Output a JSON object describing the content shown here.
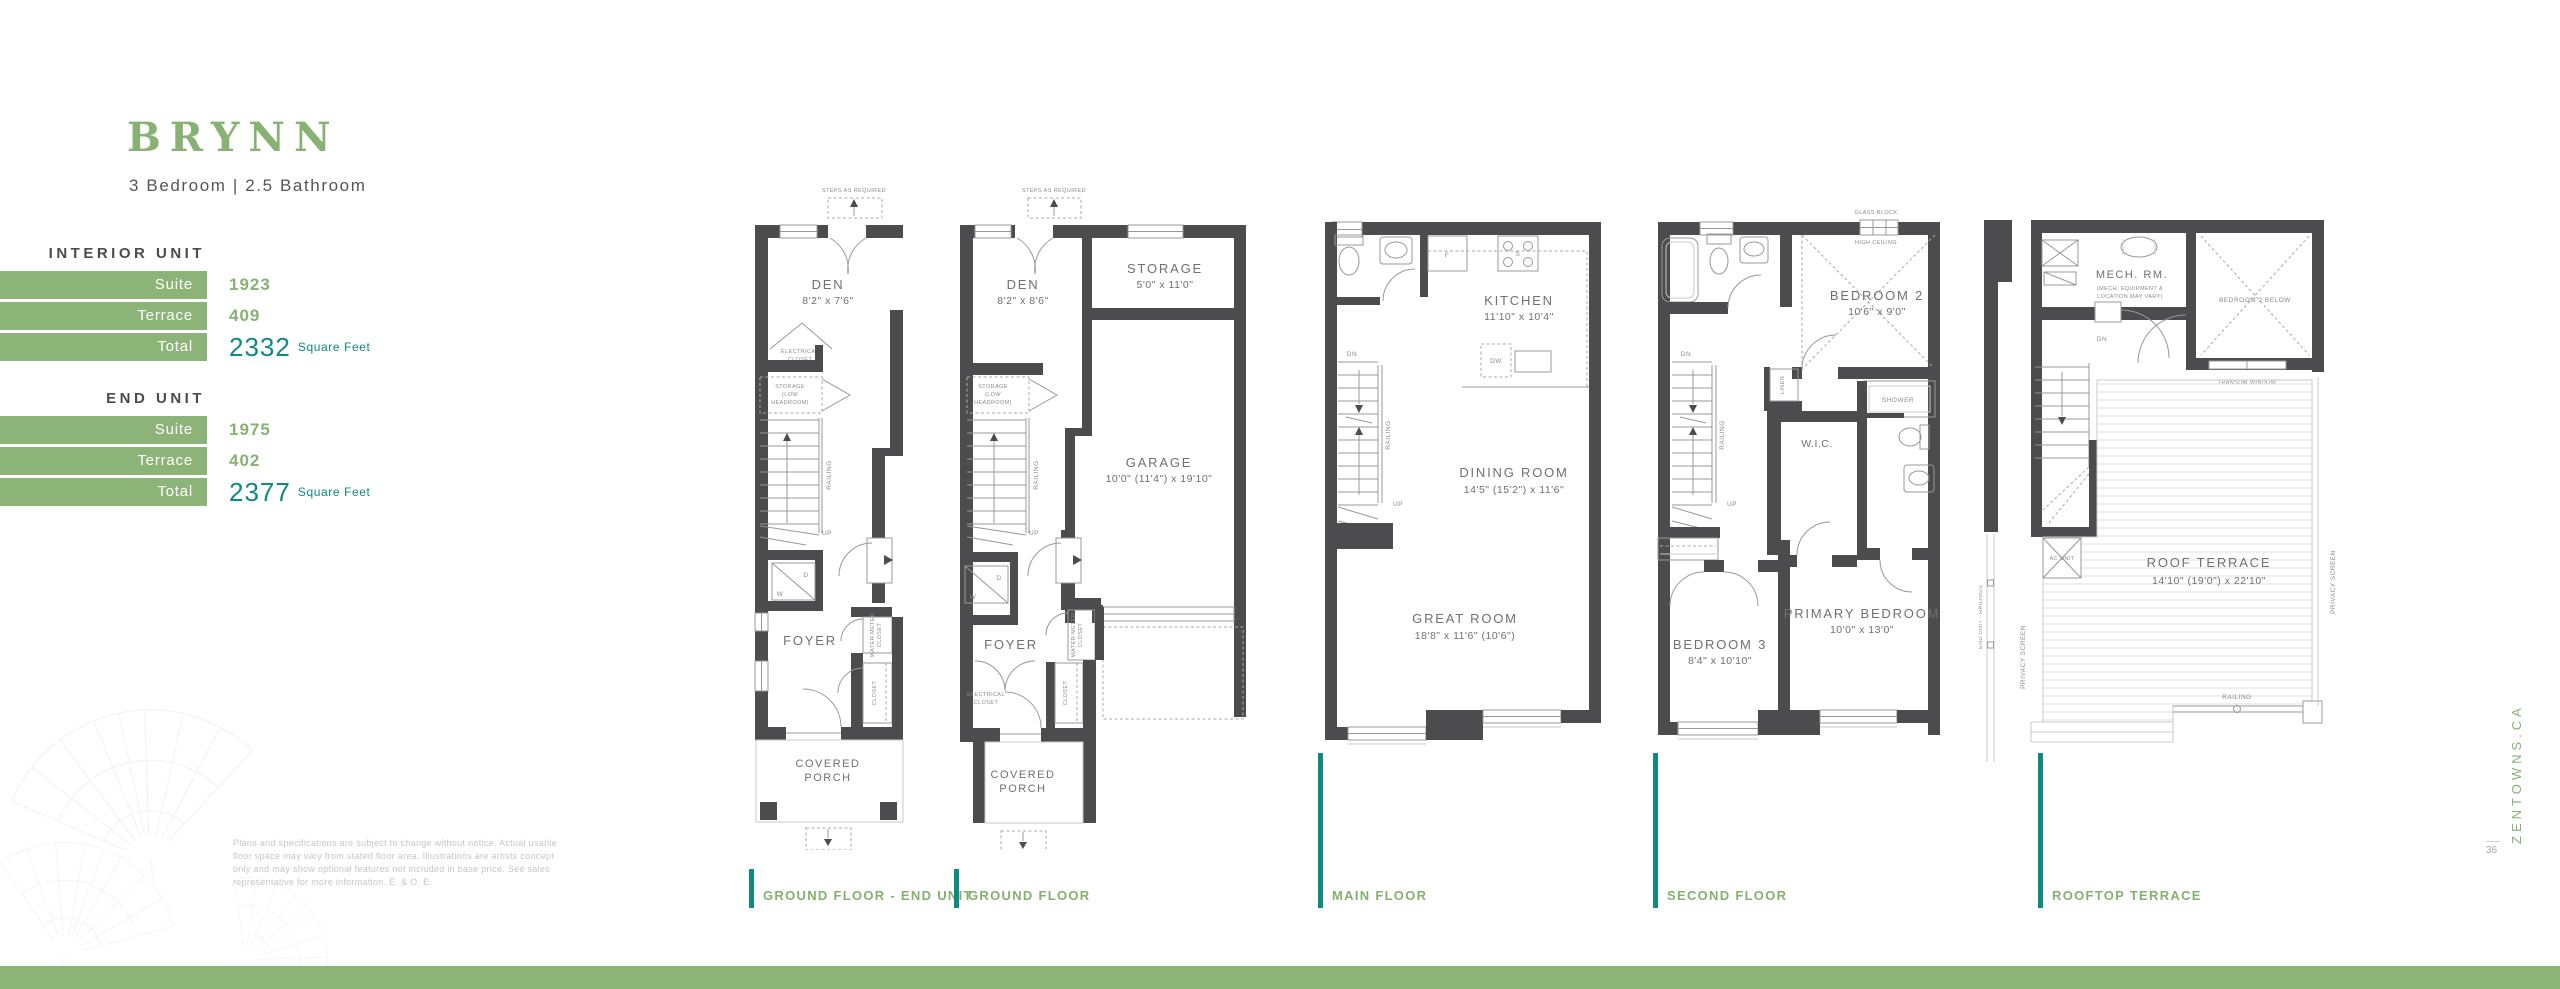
{
  "header": {
    "title": "BRYNN",
    "subtitle": "3 Bedroom | 2.5 Bathroom"
  },
  "specs": [
    {
      "heading": "INTERIOR UNIT",
      "rows": [
        {
          "label": "Suite",
          "value": "1923",
          "unit": ""
        },
        {
          "label": "Terrace",
          "value": "409",
          "unit": ""
        },
        {
          "label": "Total",
          "value": "2332",
          "unit": "Square Feet"
        }
      ]
    },
    {
      "heading": "END UNIT",
      "rows": [
        {
          "label": "Suite",
          "value": "1975",
          "unit": ""
        },
        {
          "label": "Terrace",
          "value": "402",
          "unit": ""
        },
        {
          "label": "Total",
          "value": "2377",
          "unit": "Square Feet"
        }
      ]
    }
  ],
  "plans": [
    {
      "name": "GROUND FLOOR - END UNIT",
      "labels": {
        "steps": "STEPS AS REQUIRED",
        "den": "DEN",
        "den_dim": "8'2\" x 7'6\"",
        "elec1": "ELECTRICAL",
        "elec2": "CLOSET",
        "stor1": "STORAGE",
        "stor2": "(LOW",
        "stor3": "HEADROOM)",
        "railing": "RAILING",
        "up": "UP",
        "w": "W",
        "d": "D",
        "foyer": "FOYER",
        "wm1": "WATER METER",
        "wm2": "CLOSET",
        "closet": "CLOSET",
        "porch1": "COVERED",
        "porch2": "PORCH"
      }
    },
    {
      "name": "GROUND FLOOR",
      "labels": {
        "steps": "STEPS AS REQUIRED",
        "den": "DEN",
        "den_dim": "8'2\" x 8'6\"",
        "storage": "STORAGE",
        "storage_dim": "5'0\" x 11'0\"",
        "stor1": "STORAGE",
        "stor2": "(LOW",
        "stor3": "HEADROOM)",
        "railing": "RAILING",
        "up": "UP",
        "garage": "GARAGE",
        "garage_dim": "10'0\" (11'4\") x 19'10\"",
        "w": "W",
        "d": "D",
        "foyer": "FOYER",
        "wm1": "WATER METER",
        "wm2": "CLOSET",
        "elec1": "ELECTRICAL",
        "elec2": "CLOSET",
        "closet": "CLOSET",
        "porch1": "COVERED",
        "porch2": "PORCH"
      }
    },
    {
      "name": "MAIN FLOOR",
      "labels": {
        "kitchen": "KITCHEN",
        "kitchen_dim": "11'10\" x 10'4\"",
        "f": "F",
        "s": "S",
        "dw": "DW",
        "dn": "DN",
        "up": "UP",
        "railing": "RAILING",
        "dining": "DINING ROOM",
        "dining_dim": "14'5\" (15'2\") x 11'6\"",
        "great": "GREAT ROOM",
        "great_dim": "18'8\" x 11'6\" (10'6\")"
      }
    },
    {
      "name": "SECOND FLOOR",
      "labels": {
        "glass": "GLASS BLOCK",
        "high": "HIGH CEILING",
        "bed2": "BEDROOM 2",
        "bed2_dim": "10'6\" x 9'0\"",
        "dn": "DN",
        "up": "UP",
        "railing": "RAILING",
        "linen": "LINEN",
        "wic": "W.I.C.",
        "shower": "SHOWER",
        "bed3": "BEDROOM 3",
        "bed3_dim": "8'4\" x 10'10\"",
        "primary": "PRIMARY BEDROOM",
        "primary_dim": "10'0\" x 13'0\""
      }
    },
    {
      "name": "ROOFTOP TERRACE",
      "labels": {
        "mech": "MECH. RM.",
        "mech_n1": "(MECH. EQUIPMENT &",
        "mech_n2": "LOCATION MAY VARY)",
        "bed2_below": "BEDROOM 2 BELOW",
        "transom": "TRANSOM WINDOW",
        "dn": "DN",
        "ac": "AC UNIT",
        "roof": "ROOF TERRACE",
        "roof_dim": "14'10\" (19'0\") x 22'10\"",
        "railing": "RAILING",
        "privacy_l": "PRIVACY SCREEN",
        "privacy_r": "PRIVACY SCREEN",
        "end_rail": "END UNIT - RAILINGS"
      }
    }
  ],
  "footer": {
    "disclaimer": "Plans and specifications are subject to change without notice. Actual usable floor space may vary from stated floor area.  Illustrations are artists concept only and may show optional features not included in base price.  See sales representative for more information. E. & O. E.",
    "website": "ZENTOWNS.CA",
    "page": "36"
  },
  "colors": {
    "green": "#87B273",
    "bar_green": "#8CB478",
    "teal": "#0E8A80",
    "wall": "#4C4C4E"
  }
}
